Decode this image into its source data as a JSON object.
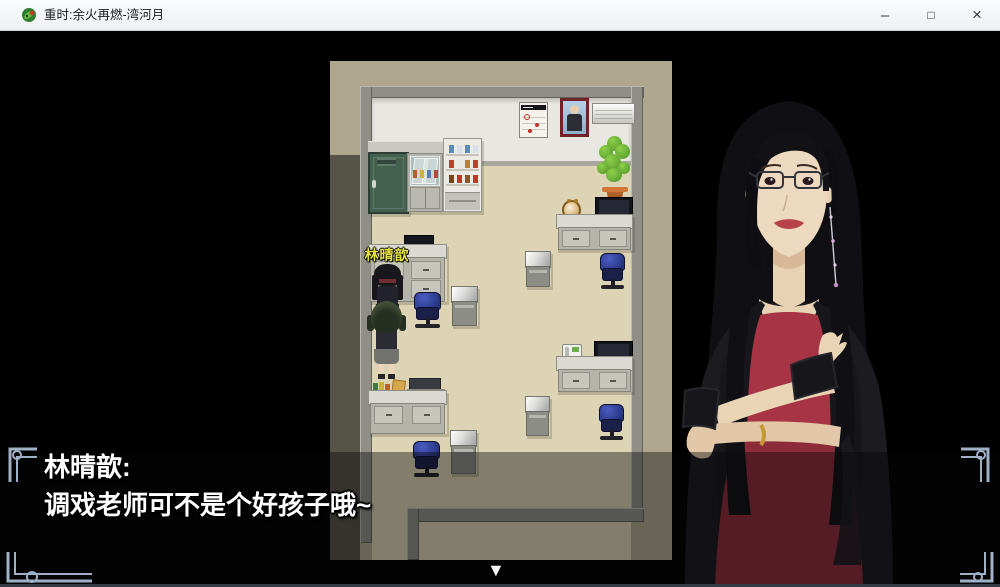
{
  "titlebar": {
    "title": "重时:余火再燃-湾河月",
    "app_icon": "game-app-icon",
    "buttons": {
      "minimize": "–",
      "maximize": "□",
      "close": "×"
    }
  },
  "map": {
    "npc_label": "林晴歆"
  },
  "dialog": {
    "speaker": "林晴歆:",
    "text": "调戏老师可不是个好孩子哦~",
    "advance_indicator": "▼"
  },
  "colors": {
    "name_label_yellow": "#e9e342",
    "floor_tan": "#dcd4b4",
    "outer_wall_beige": "#aea78e",
    "outer_floor_olive": "#565446",
    "wall_white": "#e9e7e2",
    "frame_gray": "#8f8f87",
    "chair_blue": "#2c3c9c",
    "dress_red": "#a63445",
    "skirt_red": "#8d2b3a",
    "ornament_blue_gray": "#9fb0c6",
    "dialog_dim": "rgba(8,8,10,0.42)"
  }
}
